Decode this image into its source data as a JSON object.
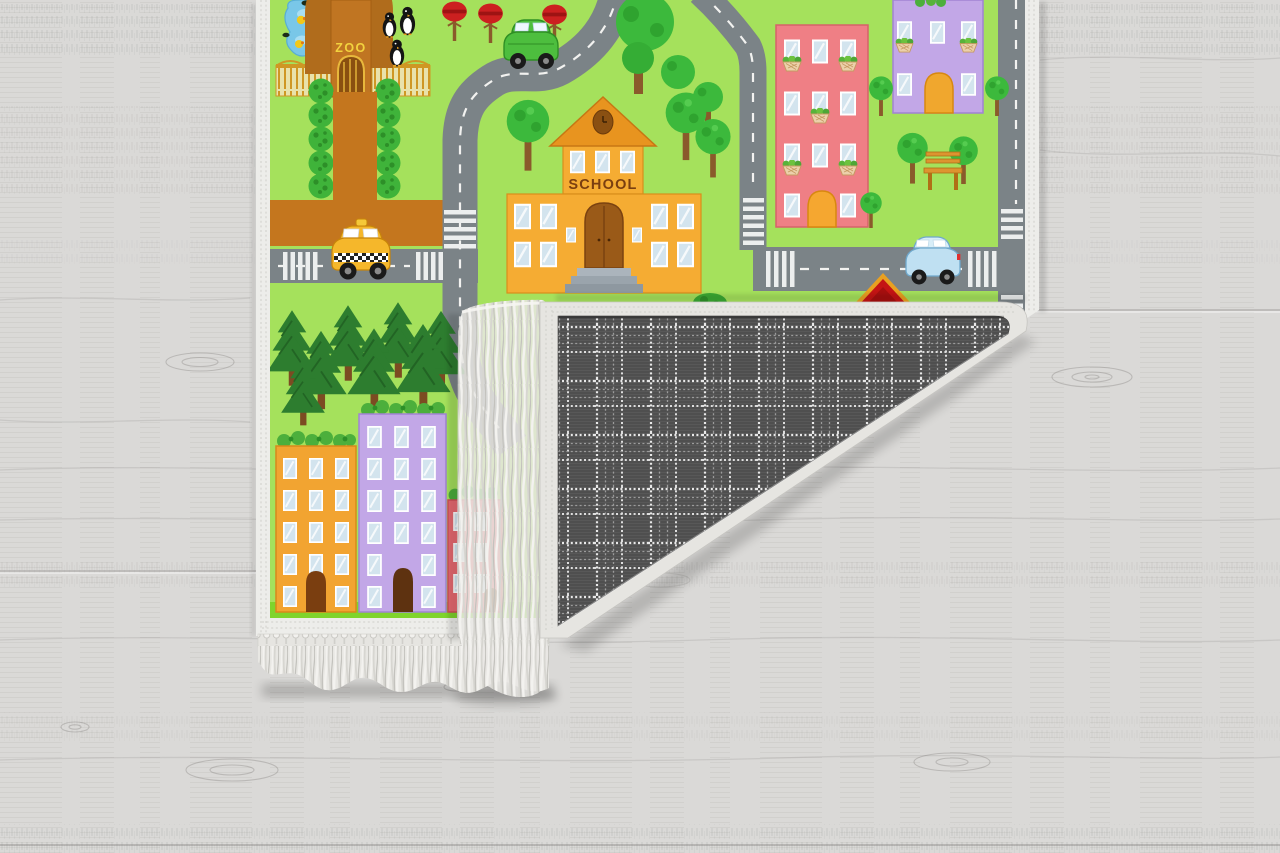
{
  "image": {
    "type": "product-photo",
    "subject": "Children's city road-map play rug lying on a whitewashed wood floor, bottom-right corner folded over to reveal grey plaid woven backing and cream fringe tassels"
  },
  "floor": {
    "material": "whitewashed wood planks",
    "base_color": "#dad9d7"
  },
  "rug": {
    "theme": "kids city traffic play mat",
    "background_color": "#a5e15c",
    "road_color": "#7b8387",
    "road_marking_color": "#ffffff",
    "park_path_color": "#c4761e",
    "border_color": "#ededea",
    "fringe_color": "#e8e7e3",
    "signs": {
      "school": "SCHOOL",
      "zoo": "ZOO"
    },
    "vehicles": [
      "yellow taxi",
      "green car",
      "blue car"
    ],
    "buildings": [
      "school",
      "pink apartment with flower boxes",
      "purple house",
      "red-roof house",
      "orange apartment block",
      "purple apartment block",
      "pink apartment block"
    ],
    "scenery": [
      "zoo entrance arch with gate",
      "duck pond",
      "penguins",
      "red trees",
      "topiary hedges",
      "round trees",
      "park bench",
      "pine forest",
      "crosswalks",
      "dashed road lines"
    ],
    "back": {
      "pattern": "windowpane plaid",
      "base_color": "#4f4f4f",
      "check_color": "#e9e9e9"
    }
  }
}
